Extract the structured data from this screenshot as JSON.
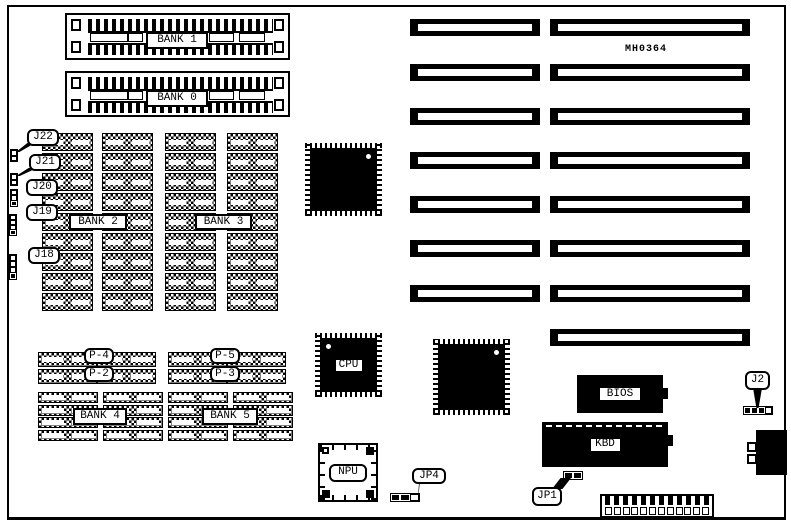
{
  "board": {
    "code": "MH0364"
  },
  "simm_sockets": [
    {
      "label": "BANK 1",
      "x": 65,
      "y": 13,
      "w": 225,
      "h": 47
    },
    {
      "label": "BANK 0",
      "x": 65,
      "y": 71,
      "w": 225,
      "h": 46
    }
  ],
  "memory": {
    "bank23_columns": {
      "xs": [
        42,
        102,
        165,
        227
      ],
      "y0": 133,
      "rows": 9,
      "chip_w": 51,
      "chip_h": 18,
      "step": 20
    },
    "p_groups": [
      {
        "xs": [
          38,
          97
        ],
        "ys": [
          352,
          369
        ],
        "chip_w": 59,
        "chip_h": 15
      },
      {
        "xs": [
          168,
          227
        ],
        "ys": [
          352,
          369
        ],
        "chip_w": 59,
        "chip_h": 15
      }
    ],
    "bank45_groups": [
      {
        "xs": [
          38,
          103
        ],
        "ys": [
          392,
          405,
          417,
          430
        ],
        "chip_w": 60,
        "chip_h": 11
      },
      {
        "xs": [
          168,
          233
        ],
        "ys": [
          392,
          405,
          417,
          430
        ],
        "chip_w": 60,
        "chip_h": 11
      }
    ]
  },
  "labels": [
    {
      "text": "BANK 2",
      "x": 69,
      "y": 214,
      "w": 58,
      "h": 16,
      "shape": "square"
    },
    {
      "text": "BANK 3",
      "x": 195,
      "y": 214,
      "w": 57,
      "h": 16,
      "shape": "square"
    },
    {
      "text": "P-4",
      "x": 84,
      "y": 348,
      "w": 30,
      "h": 16,
      "shape": "round"
    },
    {
      "text": "P-2",
      "x": 84,
      "y": 366,
      "w": 30,
      "h": 16,
      "shape": "round"
    },
    {
      "text": "P-5",
      "x": 210,
      "y": 348,
      "w": 30,
      "h": 16,
      "shape": "round"
    },
    {
      "text": "P-3",
      "x": 210,
      "y": 366,
      "w": 30,
      "h": 16,
      "shape": "round"
    },
    {
      "text": "BANK 4",
      "x": 73,
      "y": 408,
      "w": 54,
      "h": 17,
      "shape": "square"
    },
    {
      "text": "BANK 5",
      "x": 202,
      "y": 408,
      "w": 56,
      "h": 17,
      "shape": "square"
    }
  ],
  "chips": [
    {
      "name": "chipset-1",
      "x": 310,
      "y": 148,
      "w": 67,
      "h": 63,
      "dot": "tr",
      "label": ""
    },
    {
      "name": "chipset-2",
      "x": 438,
      "y": 344,
      "w": 67,
      "h": 66,
      "dot": "tr",
      "label": ""
    },
    {
      "name": "cpu",
      "x": 320,
      "y": 338,
      "w": 57,
      "h": 54,
      "dot": "tl",
      "label": "CPU"
    }
  ],
  "npu": {
    "label": "NPU",
    "x": 318,
    "y": 443,
    "w": 60,
    "h": 59
  },
  "rom_chips": [
    {
      "label": "BIOS",
      "x": 577,
      "y": 375,
      "w": 86,
      "h": 38,
      "dashed_top": false
    },
    {
      "label": "KBD",
      "x": 542,
      "y": 422,
      "w": 126,
      "h": 45,
      "dashed_top": true
    }
  ],
  "slots": {
    "left_x": 410,
    "left_w": 130,
    "right_x": 550,
    "right_w": 200,
    "h": 17,
    "pair_ys": [
      19,
      64,
      108,
      152,
      196,
      240,
      285
    ],
    "right_only_ys": [
      329
    ]
  },
  "jumpers": [
    {
      "label": "J22",
      "box": {
        "x": 27,
        "y": 129,
        "w": 32,
        "h": 17
      },
      "tail": "dl",
      "pins": {
        "x": 10,
        "y": 149,
        "w": 8,
        "h": 13,
        "dir": "v",
        "cells": [
          "open",
          "open"
        ]
      }
    },
    {
      "label": "J21",
      "box": {
        "x": 29,
        "y": 154,
        "w": 32,
        "h": 17
      },
      "tail": "dl",
      "pins": {
        "x": 10,
        "y": 173,
        "w": 8,
        "h": 13,
        "dir": "v",
        "cells": [
          "open",
          "open"
        ]
      }
    },
    {
      "label": "J20",
      "box": {
        "x": 26,
        "y": 179,
        "w": 32,
        "h": 17
      },
      "tail": "dl",
      "pins": {
        "x": 10,
        "y": 189,
        "w": 8,
        "h": 18,
        "dir": "v",
        "cells": [
          "open",
          "open",
          "filled"
        ]
      }
    },
    {
      "label": "J19",
      "box": {
        "x": 26,
        "y": 204,
        "w": 32,
        "h": 17
      },
      "tail": "dl",
      "pins": {
        "x": 9,
        "y": 214,
        "w": 8,
        "h": 22,
        "dir": "v",
        "cells": [
          "open",
          "open",
          "open",
          "filled"
        ]
      }
    },
    {
      "label": "J18",
      "box": {
        "x": 28,
        "y": 247,
        "w": 32,
        "h": 17
      },
      "tail": "dl",
      "pins": {
        "x": 9,
        "y": 254,
        "w": 8,
        "h": 26,
        "dir": "v",
        "cells": [
          "open",
          "open",
          "open",
          "filled"
        ]
      }
    },
    {
      "label": "J2",
      "box": {
        "x": 745,
        "y": 371,
        "w": 25,
        "h": 19
      },
      "tail": "d",
      "pins": {
        "x": 743,
        "y": 406,
        "w": 30,
        "h": 9,
        "dir": "h",
        "cells": [
          "filled",
          "filled",
          "filled",
          "open"
        ]
      }
    },
    {
      "label": "JP4",
      "box": {
        "x": 412,
        "y": 468,
        "w": 34,
        "h": 16
      },
      "tail": "dl",
      "pins": {
        "x": 390,
        "y": 493,
        "w": 30,
        "h": 9,
        "dir": "h",
        "cells": [
          "filled",
          "filled",
          "open"
        ]
      }
    },
    {
      "label": "JP1",
      "box": {
        "x": 532,
        "y": 487,
        "w": 30,
        "h": 19
      },
      "tail": "ur",
      "pins": {
        "x": 563,
        "y": 471,
        "w": 20,
        "h": 9,
        "dir": "h",
        "cells": [
          "filled",
          "filled"
        ]
      }
    }
  ],
  "power_connector": {
    "x": 600,
    "y": 494,
    "w": 114,
    "h": 24,
    "pins": 12
  },
  "keyboard_connector": {
    "x": 756,
    "y": 430,
    "w": 31,
    "h": 45
  }
}
